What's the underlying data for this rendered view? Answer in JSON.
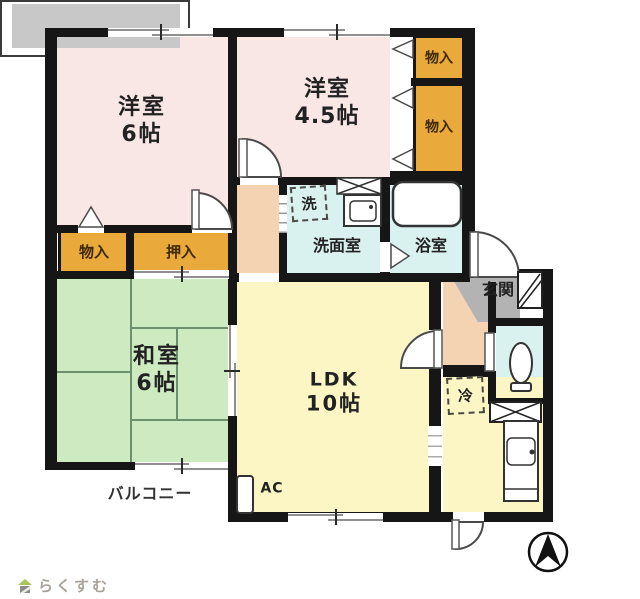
{
  "watermark": {
    "brand": "らくすむ"
  },
  "rooms": {
    "western1": {
      "name": "洋室",
      "size": "6帖"
    },
    "western2": {
      "name": "洋室",
      "size": "4.5帖"
    },
    "japanese": {
      "name": "和室",
      "size": "6帖"
    },
    "ldk": {
      "name": "LDK",
      "size": "10帖"
    },
    "washroom": {
      "label": "洗面室"
    },
    "bathroom": {
      "label": "浴室"
    },
    "entrance": {
      "label": "玄関"
    },
    "balcony": {
      "label": "バルコニー"
    }
  },
  "storages": {
    "closet_top_right": "物入",
    "closet_mid_right": "物入",
    "closet_left": "物入",
    "oshiire": "押入"
  },
  "fixtures": {
    "washer": "洗",
    "fridge": "冷",
    "ac": "AC"
  },
  "icons": {
    "compass": "north-arrow-icon",
    "logo_house": "house-icon"
  },
  "colors": {
    "western_room": "#f9e7e5",
    "japanese_room": "#cdeac1",
    "ldk": "#fbf6c4",
    "wet_area": "#d9f1ef",
    "closet": "#e9a93b",
    "corridor": "#f4d3b2",
    "entrance_floor": "#b3b3b3",
    "balcony": "#c8c8c8",
    "wall": "#161616"
  }
}
